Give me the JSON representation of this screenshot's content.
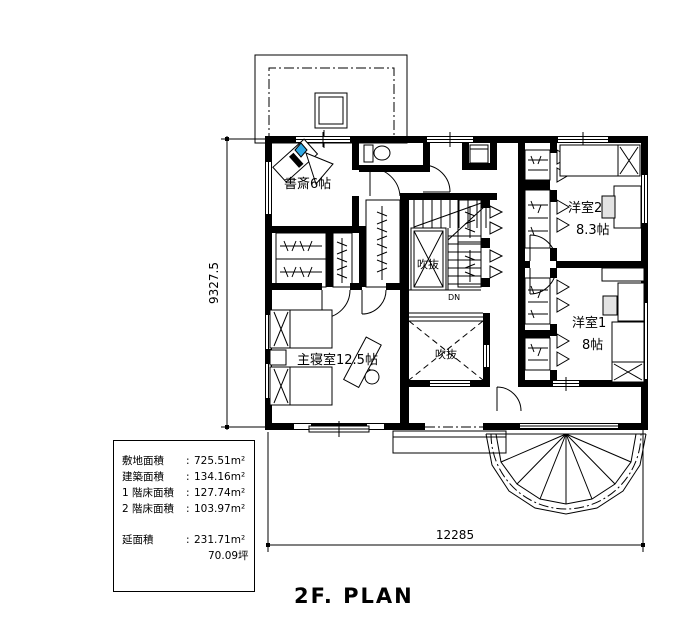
{
  "plan_title": "2F. PLAN",
  "rooms": {
    "study": {
      "label": "書斎6帖"
    },
    "master_bedroom": {
      "label": "主寝室12.5帖"
    },
    "western_room_2": {
      "name": "洋室2",
      "size": "8.3帖"
    },
    "western_room_1": {
      "name": "洋室1",
      "size": "8帖"
    },
    "void_upper": {
      "label": "吹抜"
    },
    "void_lower": {
      "label": "吹抜"
    },
    "stairs": {
      "down_label": "DN"
    }
  },
  "dimensions": {
    "overall_width_mm": "12285",
    "overall_height_mm": "9327.5"
  },
  "area_table": {
    "rows": [
      {
        "label": "敷地面積",
        "sep": ":",
        "value": "725.51m²"
      },
      {
        "label": "建築面積",
        "sep": ":",
        "value": "134.16m²"
      },
      {
        "label": "1 階床面積",
        "sep": ":",
        "value": "127.74m²"
      },
      {
        "label": "2 階床面積",
        "sep": ":",
        "value": "103.97m²"
      },
      {
        "label": "延面積",
        "sep": ":",
        "value": "231.71m²"
      },
      {
        "label": "",
        "sep": "",
        "value": "70.09坪"
      }
    ]
  },
  "colors": {
    "line": "#000000",
    "background": "#ffffff",
    "accent_blue": "#2FA8E4",
    "chair_gray": "#e3e3e3"
  }
}
